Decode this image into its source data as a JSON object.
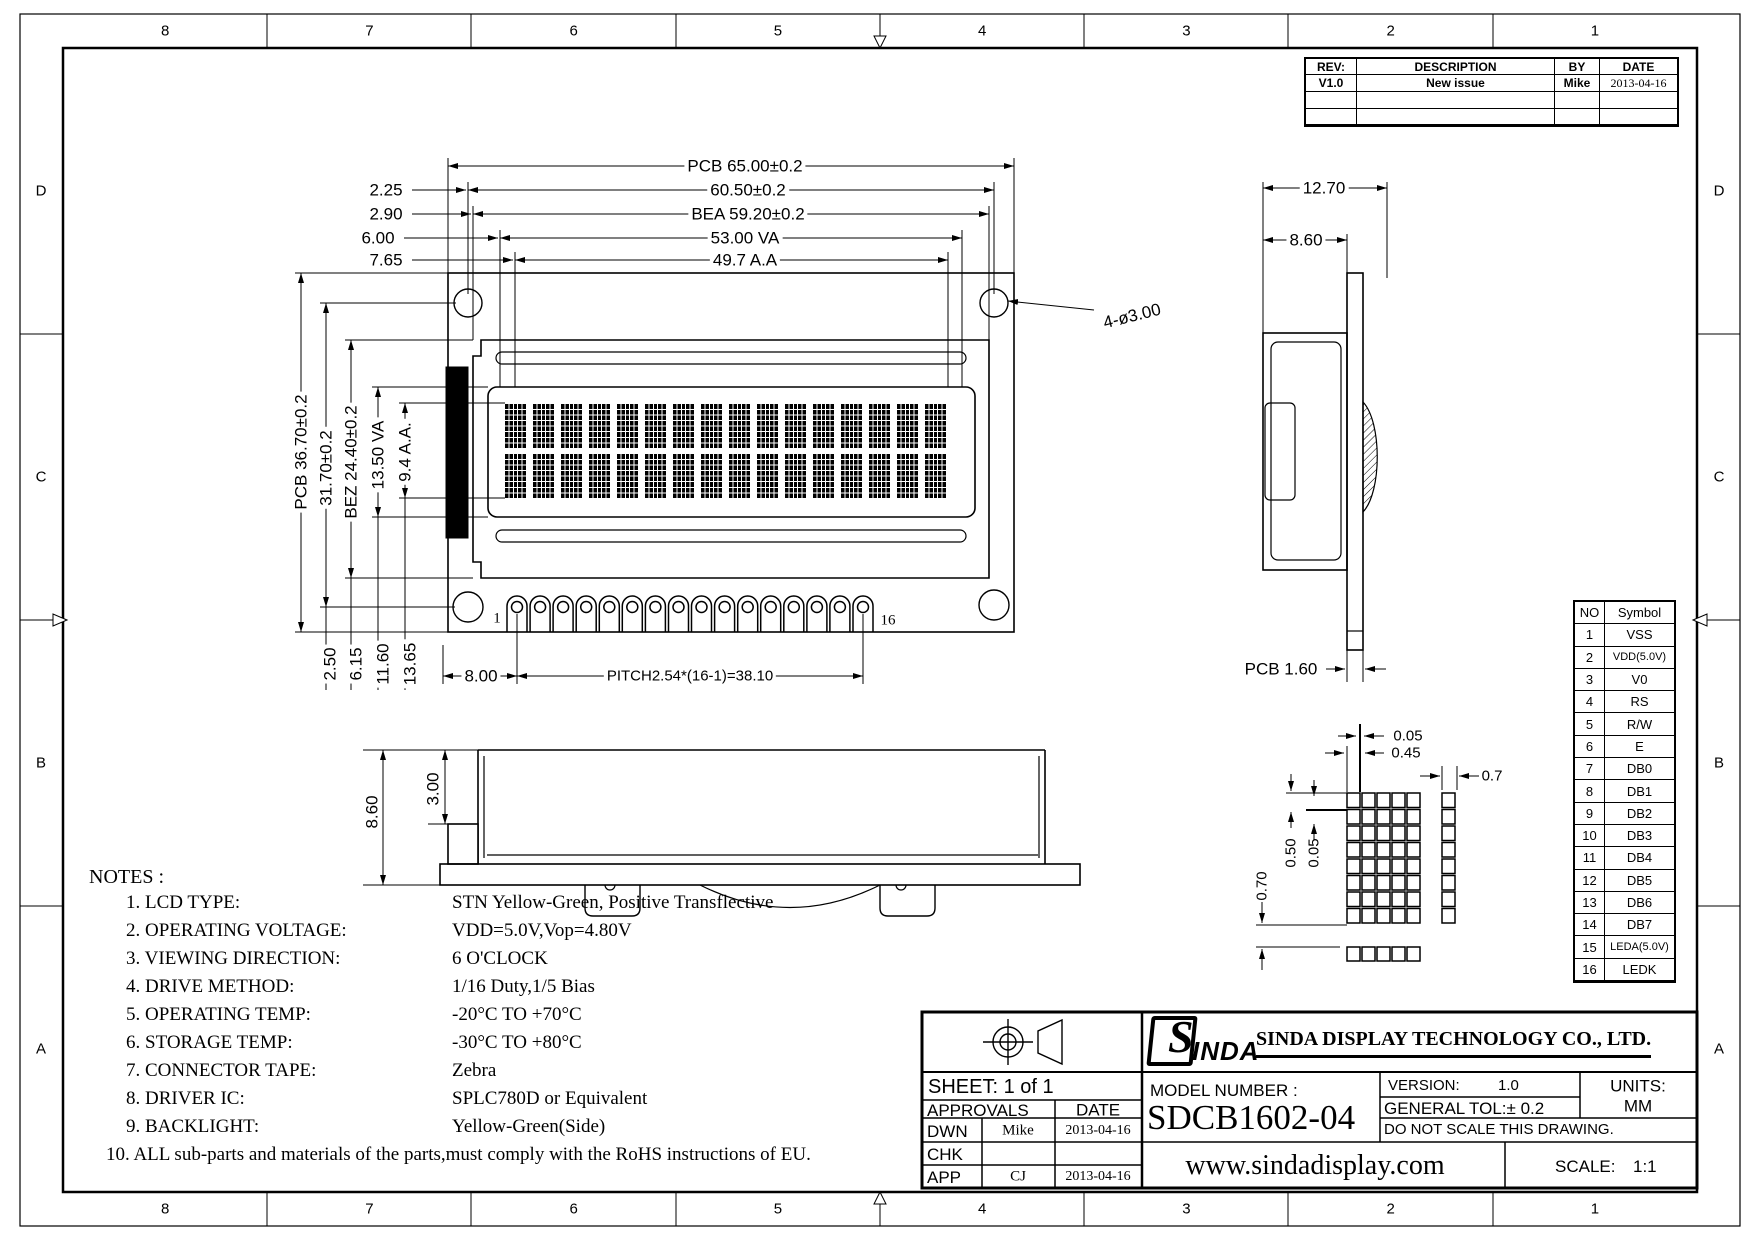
{
  "sheet": {
    "zones_top": [
      "8",
      "7",
      "6",
      "5",
      "4",
      "3",
      "2",
      "1"
    ],
    "zones_bottom": [
      "8",
      "7",
      "6",
      "5",
      "4",
      "3",
      "2",
      "1"
    ],
    "zones_left": [
      "D",
      "C",
      "B",
      "A"
    ],
    "zones_right": [
      "D",
      "C",
      "B",
      "A"
    ],
    "line_color": "#000000",
    "bg_color": "#ffffff"
  },
  "revision_table": {
    "headers": {
      "rev": "REV:",
      "description": "DESCRIPTION",
      "by": "BY",
      "date": "DATE"
    },
    "rows": [
      {
        "rev": "V1.0",
        "description": "New  issue",
        "by": "Mike",
        "date": "2013-04-16"
      },
      {
        "rev": "",
        "description": "",
        "by": "",
        "date": ""
      },
      {
        "rev": "",
        "description": "",
        "by": "",
        "date": ""
      }
    ]
  },
  "dims": {
    "pcb_width": "PCB  65.00±0.2",
    "mount_width": "60.50±0.2",
    "bea_width": "BEA  59.20±0.2",
    "va_width": "53.00  VA",
    "aa_width": "49.7  A.A",
    "offset_225": "2.25",
    "offset_290": "2.90",
    "offset_600": "6.00",
    "offset_765": "7.65",
    "pcb_height": "PCB  36.70±0.2",
    "mount_height": "31.70±0.2",
    "bez_height": "BEZ  24.40±0.2",
    "va_height": "13.50  VA",
    "aa_height": "9.4  A.A.",
    "offset_250": "2.50",
    "offset_615": "6.15",
    "offset_1160": "11.60",
    "offset_1365": "13.65",
    "pin_offset": "8.00",
    "pin_pitch": "PITCH2.54*(16-1)=38.10",
    "hole_note": "4-ø3.00",
    "pin_first": "1",
    "pin_last": "16",
    "side_width": "12.70",
    "side_bezel": "8.60",
    "pcb_thick": "PCB  1.60",
    "bottom_total": "8.60",
    "bottom_step": "3.00",
    "dot_gap_x": "0.05",
    "dot_width": "0.45",
    "dot_col": "0.7",
    "dot_height": "0.50",
    "dot_gap_y": "0.05",
    "dot_row": "0.70"
  },
  "pin_table": {
    "headers": [
      "NO",
      "Symbol"
    ],
    "rows": [
      [
        "1",
        "VSS"
      ],
      [
        "2",
        "VDD(5.0V)"
      ],
      [
        "3",
        "V0"
      ],
      [
        "4",
        "RS"
      ],
      [
        "5",
        "R/W"
      ],
      [
        "6",
        "E"
      ],
      [
        "7",
        "DB0"
      ],
      [
        "8",
        "DB1"
      ],
      [
        "9",
        "DB2"
      ],
      [
        "10",
        "DB3"
      ],
      [
        "11",
        "DB4"
      ],
      [
        "12",
        "DB5"
      ],
      [
        "13",
        "DB6"
      ],
      [
        "14",
        "DB7"
      ],
      [
        "15",
        "LEDA(5.0V)"
      ],
      [
        "16",
        "LEDK"
      ]
    ]
  },
  "notes": {
    "title": "NOTES :",
    "items": [
      {
        "label": "1. LCD TYPE:",
        "value": "STN Yellow-Green, Positive Transflective"
      },
      {
        "label": "2. OPERATING VOLTAGE:",
        "value": "VDD=5.0V,Vop=4.80V"
      },
      {
        "label": "3. VIEWING DIRECTION:",
        "value": "6 O'CLOCK"
      },
      {
        "label": "4. DRIVE METHOD:",
        "value": "1/16 Duty,1/5 Bias"
      },
      {
        "label": "5. OPERATING TEMP:",
        "value": "-20°C TO +70°C"
      },
      {
        "label": "6. STORAGE TEMP:",
        "value": "-30°C TO +80°C"
      },
      {
        "label": "7. CONNECTOR TAPE:",
        "value": "Zebra"
      },
      {
        "label": "8. DRIVER IC:",
        "value": "SPLC780D or Equivalent"
      },
      {
        "label": "9. BACKLIGHT:",
        "value": "Yellow-Green(Side)"
      },
      {
        "label": "10. ALL sub-parts and materials of the parts,must comply with the RoHS instructions of EU.",
        "value": ""
      }
    ]
  },
  "title_block": {
    "sheet_label": "SHEET:   1   of   1",
    "approvals_label": "APPROVALS",
    "date_label": "DATE",
    "rows": [
      {
        "role": "DWN",
        "name": "Mike",
        "date": "2013-04-16"
      },
      {
        "role": "CHK",
        "name": "",
        "date": ""
      },
      {
        "role": "APP",
        "name": "CJ",
        "date": "2013-04-16"
      }
    ],
    "logo_s": "S",
    "logo_inda": "INDA",
    "company": "SINDA DISPLAY  TECHNOLOGY  CO., LTD.",
    "model_label": "MODEL  NUMBER  :",
    "model": "SDCB1602-04",
    "version_label": "VERSION:",
    "version": "1.0",
    "tolerance": "GENERAL  TOL:±  0.2",
    "noscale": "DO  NOT  SCALE  THIS  DRAWING.",
    "units_label": "UNITS:",
    "units": "MM",
    "website": "www.sindadisplay.com",
    "scale_label": "SCALE:",
    "scale": "1:1"
  },
  "display": {
    "char_cols": 16,
    "char_rows": 2,
    "dot_cols": 5,
    "dot_rows": 8,
    "pin_count": 16
  }
}
